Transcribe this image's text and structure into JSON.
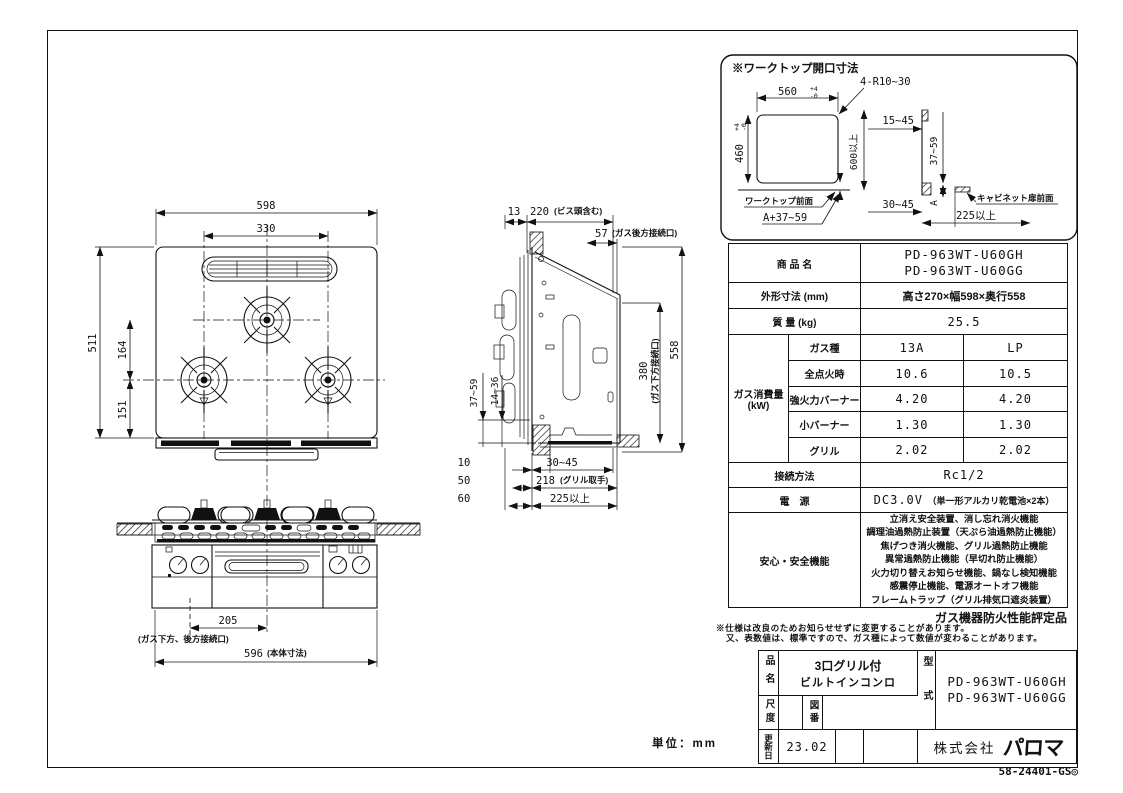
{
  "meta": {
    "line_color": "#111111",
    "background": "#ffffff",
    "unit_label": "単位：mm",
    "doc_number": "58-24401-GS◎"
  },
  "worktop": {
    "title": "※ワークトップ開口寸法",
    "opening_width": "560",
    "tol_plus": "+4",
    "tol_minus": "-0",
    "opening_depth": "460",
    "tol_plus2": "+4",
    "tol_minus2": "-0",
    "corner_radius": "4-R10~30",
    "depth_min": "600以上",
    "front_label": "ワークトップ前面",
    "a_plus_range": "A+37~59",
    "range_15_45": "15~45",
    "range_37_59": "37~59",
    "a_label": "A",
    "range_30_45": "30~45",
    "cabinet_label": "キャビネット扉前面",
    "min_225": "225以上"
  },
  "top_view": {
    "width": "598",
    "burner_span": "330",
    "depth": "511",
    "back_to_front": "164",
    "front_to_edge": "151"
  },
  "side_view": {
    "top_plate": "13",
    "under_counter": "220",
    "under_counter_note": "(ビス頭含む)",
    "gas_rear": "57",
    "gas_rear_note": "(ガス後方接続口)",
    "depth": "558",
    "gas_bottom": "380",
    "gas_bottom_note": "(ガス下方接続口)",
    "range_37_59": "37~59",
    "range_14_36": "14~36",
    "dim_10": "10",
    "range_30_45": "30~45",
    "dim_50": "50",
    "dim_218": "218",
    "dim_218_note": "(グリル取手)",
    "dim_60": "60",
    "min_225": "225以上"
  },
  "front_view": {
    "gas_offset": "205",
    "gas_offset_note": "(ガス下方、後方接続口)",
    "body_width": "596",
    "body_width_note": "(本体寸法)"
  },
  "spec": {
    "product_label": "商 品 名",
    "product_line1": "PD-963WT-U60GH",
    "product_line2": "PD-963WT-U60GG",
    "dims_label": "外形寸法 (mm)",
    "dims_value": "高さ270×幅598×奥行558",
    "weight_label": "質 量 (kg)",
    "weight_value": "25.5",
    "gas_label_line1": "ガス消費量",
    "gas_label_line2": "(kW)",
    "gas_rows": [
      {
        "label": "ガス種",
        "v13a": "13A",
        "vlp": "LP"
      },
      {
        "label": "全点火時",
        "v13a": "10.6",
        "vlp": "10.5"
      },
      {
        "label": "強火力バーナー",
        "v13a": "4.20",
        "vlp": "4.20"
      },
      {
        "label": "小バーナー",
        "v13a": "1.30",
        "vlp": "1.30"
      },
      {
        "label": "グリル",
        "v13a": "2.02",
        "vlp": "2.02"
      }
    ],
    "connection_label": "接続方法",
    "connection_value": "Rc1/2",
    "power_label": "電　源",
    "power_value_main": "DC3.0V",
    "power_value_note": "（単一形アルカリ乾電池×2本）",
    "safety_label": "安心・安全機能",
    "safety_lines": [
      "立消え安全装置、消し忘れ消火機能",
      "調理油過熱防止装置（天ぷら油過熱防止機能）",
      "焦げつき消火機能、グリル過熱防止機能",
      "異常過熱防止機能（早切れ防止機能）",
      "火力切り替えお知らせ機能、鍋なし検知機能",
      "感震停止機能、電源オートオフ機能",
      "フレームトラップ（グリル排気口遮炎装置）"
    ],
    "fire_rating": "ガス機器防火性能評定品",
    "note1": "※仕様は改良のためお知らせせずに変更することがあります。",
    "note2": "又、表数値は、標準ですので、ガス種によって数値が変わることがあります。"
  },
  "title_block": {
    "name_label": "品名",
    "name_line1": "3口グリル付",
    "name_line2": "ビルトインコンロ",
    "scale_label": "尺度",
    "drawing_no_label": "図番",
    "model_label": "型式",
    "model_line1": "PD-963WT-U60GH",
    "model_line2": "PD-963WT-U60GG",
    "updated_label": "更新日",
    "updated_value": "23.02",
    "company_prefix": "株式会社",
    "company_logo": "パロマ"
  }
}
